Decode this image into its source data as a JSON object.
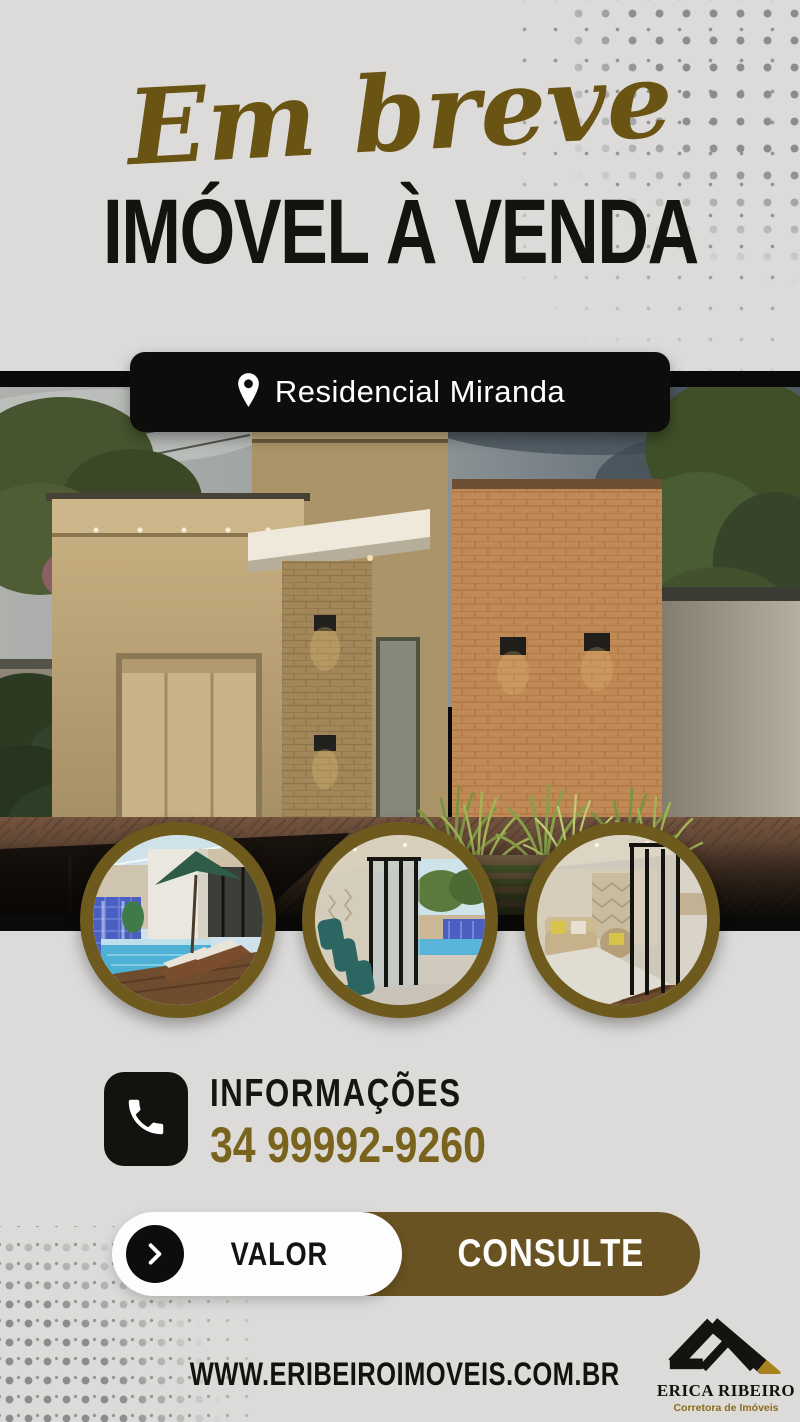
{
  "header": {
    "script_title": "Em breve",
    "main_title": "IMÓVEL À VENDA"
  },
  "location_badge": {
    "label": "Residencial Miranda"
  },
  "contact": {
    "heading": "INFORMAÇÕES",
    "phone": "34 99992-9260"
  },
  "cta": {
    "label_left": "VALOR",
    "label_right": "CONSULTE"
  },
  "footer": {
    "website": "WWW.ERIBEIROIMOVEIS.COM.BR",
    "brand_name": "ERICA RIBEIRO",
    "brand_tagline": "Corretora de Imóveis"
  },
  "icons": {
    "location": "location-pin-icon",
    "phone": "phone-icon",
    "arrow": "chevron-right-icon",
    "brand": "roof-logo-icon"
  },
  "colors": {
    "background": "#dcdbd9",
    "black": "#0d0d0c",
    "script_gold": "#6a5414",
    "phone_gold": "#79631d",
    "cta_brown": "#6a5322",
    "circle_border_olive": "#6f5a1e",
    "halftone_gray": "#8c8c8c",
    "white": "#fdfdfd"
  }
}
